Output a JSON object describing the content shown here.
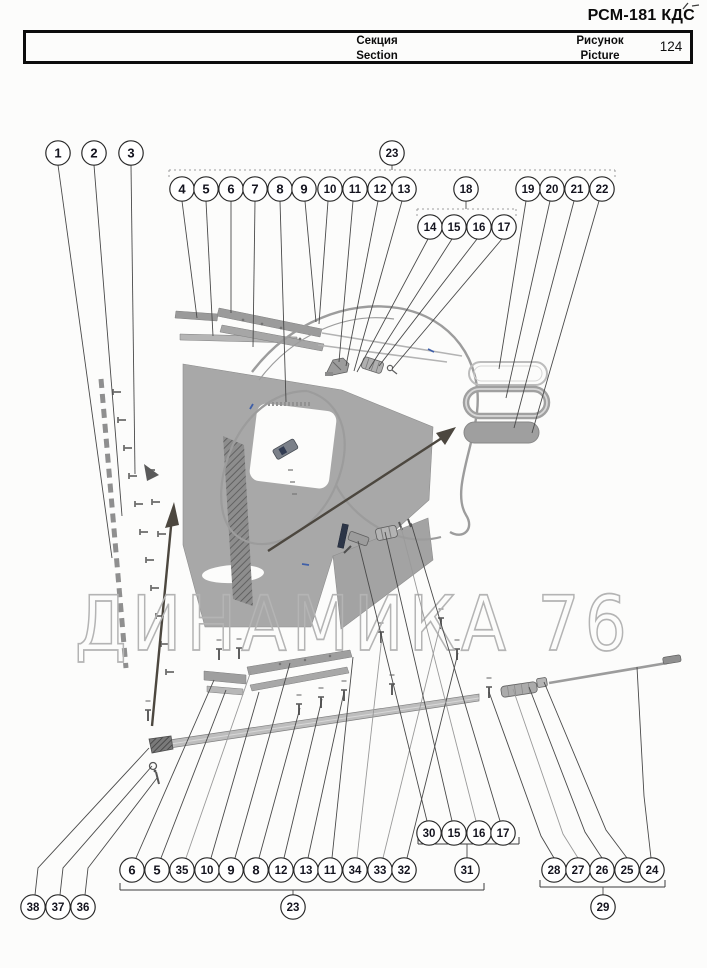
{
  "header": {
    "doc_code": "РСМ-181 КДС",
    "table": {
      "section_ru": "Секция",
      "section_en": "Section",
      "picture_ru": "Рисунок",
      "picture_en": "Picture",
      "picture_number": "124"
    }
  },
  "watermark": "ДИНАМИКА 76",
  "colors": {
    "leader": "#4a4a4a",
    "leader_light": "#9a9a9a",
    "circle_stroke": "#2b2b2b",
    "circle_fill": "#ffffff",
    "circle_text": "#14141f",
    "bracket_solid": "#3c3c3c",
    "bracket_dotted": "#9d9d9d",
    "watermark_stroke": "#b4b4b4",
    "panel_gray": "#a8a8a8"
  },
  "callouts": [
    {
      "label": "1",
      "cx": 58,
      "cy": 153,
      "leader": [
        [
          58,
          165
        ],
        [
          112,
          558
        ]
      ]
    },
    {
      "label": "2",
      "cx": 94,
      "cy": 153,
      "leader": [
        [
          94,
          165
        ],
        [
          122,
          516
        ]
      ]
    },
    {
      "label": "3",
      "cx": 131,
      "cy": 153,
      "leader": [
        [
          131,
          165
        ],
        [
          135,
          474
        ]
      ]
    },
    {
      "label": "4",
      "cx": 182,
      "cy": 189,
      "leader": [
        [
          182,
          201
        ],
        [
          197,
          318
        ]
      ]
    },
    {
      "label": "5",
      "cx": 206,
      "cy": 189,
      "leader": [
        [
          206,
          201
        ],
        [
          213,
          336
        ]
      ]
    },
    {
      "label": "6",
      "cx": 231,
      "cy": 189,
      "leader": [
        [
          231,
          201
        ],
        [
          231,
          313
        ]
      ]
    },
    {
      "label": "7",
      "cx": 255,
      "cy": 189,
      "leader": [
        [
          255,
          201
        ],
        [
          253,
          347
        ]
      ]
    },
    {
      "label": "8",
      "cx": 280,
      "cy": 189,
      "leader": [
        [
          280,
          201
        ],
        [
          286,
          402
        ]
      ]
    },
    {
      "label": "9",
      "cx": 304,
      "cy": 189,
      "leader": [
        [
          305,
          201
        ],
        [
          316,
          322
        ]
      ]
    },
    {
      "label": "10",
      "cx": 330,
      "cy": 189,
      "leader": [
        [
          328,
          201
        ],
        [
          319,
          324
        ]
      ]
    },
    {
      "label": "11",
      "cx": 355,
      "cy": 189,
      "leader": [
        [
          353,
          201
        ],
        [
          339,
          362
        ]
      ]
    },
    {
      "label": "12",
      "cx": 380,
      "cy": 189,
      "leader": [
        [
          378,
          201
        ],
        [
          346,
          366
        ]
      ]
    },
    {
      "label": "13",
      "cx": 404,
      "cy": 189,
      "leader": [
        [
          402,
          201
        ],
        [
          354,
          371
        ]
      ]
    },
    {
      "label": "14",
      "cx": 430,
      "cy": 227,
      "leader": [
        [
          428,
          239
        ],
        [
          357,
          372
        ]
      ]
    },
    {
      "label": "15",
      "cx": 454,
      "cy": 227,
      "leader": [
        [
          452,
          239
        ],
        [
          369,
          369
        ]
      ]
    },
    {
      "label": "16",
      "cx": 479,
      "cy": 227,
      "leader": [
        [
          477,
          239
        ],
        [
          379,
          366
        ]
      ]
    },
    {
      "label": "17",
      "cx": 504,
      "cy": 227,
      "leader": [
        [
          502,
          239
        ],
        [
          392,
          369
        ]
      ]
    },
    {
      "label": "19",
      "cx": 528,
      "cy": 189,
      "leader": [
        [
          526,
          201
        ],
        [
          499,
          369
        ]
      ]
    },
    {
      "label": "20",
      "cx": 552,
      "cy": 189,
      "leader": [
        [
          550,
          201
        ],
        [
          506,
          398
        ]
      ]
    },
    {
      "label": "21",
      "cx": 577,
      "cy": 189,
      "leader": [
        [
          574,
          201
        ],
        [
          514,
          428
        ]
      ]
    },
    {
      "label": "22",
      "cx": 602,
      "cy": 189,
      "leader": [
        [
          599,
          201
        ],
        [
          532,
          433
        ]
      ]
    },
    {
      "label": "6",
      "cx": 132,
      "cy": 870,
      "leader": [
        [
          136,
          858
        ],
        [
          214,
          680
        ]
      ]
    },
    {
      "label": "5",
      "cx": 157,
      "cy": 870,
      "leader": [
        [
          161,
          858
        ],
        [
          226,
          690
        ]
      ]
    },
    {
      "label": "35",
      "cx": 182,
      "cy": 870,
      "leader": [
        [
          186,
          858
        ],
        [
          251,
          671
        ]
      ],
      "light": true
    },
    {
      "label": "10",
      "cx": 207,
      "cy": 870,
      "leader": [
        [
          211,
          858
        ],
        [
          259,
          692
        ]
      ]
    },
    {
      "label": "9",
      "cx": 231,
      "cy": 870,
      "leader": [
        [
          235,
          858
        ],
        [
          290,
          663
        ]
      ]
    },
    {
      "label": "8",
      "cx": 256,
      "cy": 870,
      "leader": [
        [
          259,
          858
        ],
        [
          300,
          708
        ]
      ]
    },
    {
      "label": "12",
      "cx": 281,
      "cy": 870,
      "leader": [
        [
          284,
          858
        ],
        [
          322,
          699
        ]
      ]
    },
    {
      "label": "13",
      "cx": 306,
      "cy": 870,
      "leader": [
        [
          308,
          858
        ],
        [
          344,
          692
        ]
      ]
    },
    {
      "label": "11",
      "cx": 330,
      "cy": 870,
      "leader": [
        [
          332,
          858
        ],
        [
          353,
          657
        ]
      ]
    },
    {
      "label": "34",
      "cx": 355,
      "cy": 870,
      "leader": [
        [
          357,
          858
        ],
        [
          382,
          636
        ]
      ],
      "light": true
    },
    {
      "label": "33",
      "cx": 380,
      "cy": 870,
      "leader": [
        [
          383,
          858
        ],
        [
          441,
          622
        ]
      ],
      "light": true
    },
    {
      "label": "32",
      "cx": 404,
      "cy": 870,
      "leader": [
        [
          407,
          858
        ],
        [
          458,
          653
        ]
      ]
    },
    {
      "label": "30",
      "cx": 429,
      "cy": 833,
      "leader": [
        [
          427,
          821
        ],
        [
          358,
          541
        ]
      ]
    },
    {
      "label": "15",
      "cx": 454,
      "cy": 833,
      "leader": [
        [
          452,
          821
        ],
        [
          385,
          532
        ]
      ]
    },
    {
      "label": "16",
      "cx": 479,
      "cy": 833,
      "leader": [
        [
          476,
          821
        ],
        [
          401,
          527
        ]
      ],
      "light": true
    },
    {
      "label": "17",
      "cx": 503,
      "cy": 833,
      "leader": [
        [
          500,
          821
        ],
        [
          411,
          523
        ]
      ]
    },
    {
      "label": "28",
      "cx": 554,
      "cy": 870,
      "leader": [
        [
          554,
          858
        ],
        [
          541,
          836
        ],
        [
          489,
          692
        ]
      ]
    },
    {
      "label": "27",
      "cx": 578,
      "cy": 870,
      "leader": [
        [
          578,
          858
        ],
        [
          563,
          834
        ],
        [
          513,
          689
        ]
      ],
      "light": true
    },
    {
      "label": "26",
      "cx": 602,
      "cy": 870,
      "leader": [
        [
          602,
          858
        ],
        [
          585,
          832
        ],
        [
          529,
          687
        ]
      ]
    },
    {
      "label": "25",
      "cx": 627,
      "cy": 870,
      "leader": [
        [
          627,
          858
        ],
        [
          606,
          830
        ],
        [
          544,
          682
        ]
      ]
    },
    {
      "label": "24",
      "cx": 652,
      "cy": 870,
      "leader": [
        [
          651,
          858
        ],
        [
          644,
          796
        ],
        [
          637,
          667
        ]
      ]
    },
    {
      "label": "38",
      "cx": 33,
      "cy": 907,
      "leader": [
        [
          35,
          895
        ],
        [
          38,
          868
        ],
        [
          149,
          748
        ]
      ]
    },
    {
      "label": "37",
      "cx": 58,
      "cy": 907,
      "leader": [
        [
          60,
          895
        ],
        [
          63,
          868
        ],
        [
          152,
          766
        ]
      ]
    },
    {
      "label": "36",
      "cx": 83,
      "cy": 907,
      "leader": [
        [
          85,
          895
        ],
        [
          88,
          868
        ],
        [
          157,
          778
        ]
      ]
    }
  ],
  "groups": [
    {
      "label": "23",
      "cx": 392,
      "cy": 153,
      "bar_y": 170,
      "x1": 169,
      "x2": 615,
      "dotted": true,
      "tick_dy": 7
    },
    {
      "label": "18",
      "cx": 466,
      "cy": 189,
      "bar_y": 209,
      "x1": 417,
      "x2": 516,
      "dotted": true,
      "tick_dy": 7
    },
    {
      "label": "23",
      "cx": 293,
      "cy": 907,
      "bar_y": 890,
      "x1": 120,
      "x2": 484,
      "dotted": false,
      "tick_dy": -7
    },
    {
      "label": "31",
      "cx": 467,
      "cy": 870,
      "bar_y": 844,
      "x1": 418,
      "x2": 519,
      "dotted": false,
      "tick_dy": -7
    },
    {
      "label": "29",
      "cx": 603,
      "cy": 907,
      "bar_y": 887,
      "x1": 540,
      "x2": 665,
      "dotted": false,
      "tick_dy": -7
    }
  ]
}
